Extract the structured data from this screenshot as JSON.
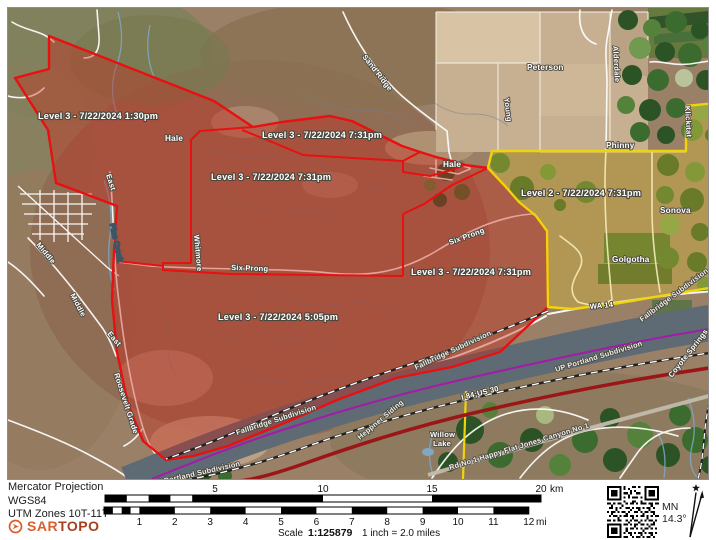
{
  "colors": {
    "level3": "#e81010",
    "level2": "#f0d40a",
    "state_line": "#a818a8",
    "interstate": "#9b1616",
    "river": "#5e6a74",
    "sartopo_orange": "#dd5f2d"
  },
  "map": {
    "zone_labels": {
      "nw": "Level 3 - 7/22/2024 1:30pm",
      "north": "Level 3 - 7/22/2024 7:31pm",
      "central": "Level 3 - 7/22/2024 7:31pm",
      "east": "Level 3 - 7/22/2024 7:31pm",
      "south": "Level 3 - 7/22/2024 5:05pm",
      "level2": "Level 2 - 7/22/2024 7:31pm"
    },
    "places": {
      "peterson": "Peterson",
      "hale_w": "Hale",
      "hale_e": "Hale",
      "phinny": "Phinny",
      "sonova": "Sonova",
      "golgotha": "Golgotha",
      "willow_line1": "Willow",
      "willow_line2": "Lake"
    },
    "roads": {
      "sand_ridge": "Sand Ridge",
      "alderdale": "Alderdale",
      "klickitat": "Klickitat",
      "young": "Young",
      "whitmore": "Whitmore",
      "east_n": "East",
      "east_s": "East",
      "middle_n": "Middle",
      "middle_s": "Middle",
      "roosevelt_grade": "Roosevelt Grade",
      "six_prong_w": "Six Prong",
      "six_prong_e": "Six Prong",
      "wa14": "WA 14",
      "i84": "I 84;US 30",
      "canyon_rd": "Rd No 1   Happy Flat Jones Canyon No 1",
      "coyote": "Coyote Springs"
    },
    "railroads": {
      "fallbridge_w": "Fallbridge Subdivision",
      "fallbridge_mid": "Fallbridge Subdivision",
      "fallbridge_e": "Fallbridge Subdivision",
      "up_portland": "UP Portland Subdivision",
      "up_portland_sw": "UP Portland Subdivision",
      "heppner_siding": "Heppner Siding"
    },
    "water": {
      "pine_creek": "Pine Creek"
    }
  },
  "footer": {
    "projection": "Mercator Projection",
    "datum": "WGS84",
    "utm_zones": "UTM Zones 10T-11T",
    "logo": {
      "sar": "SAR",
      "topo": "TOPO"
    },
    "scale_bar_km": {
      "ticks": [
        "5",
        "10",
        "15",
        "20"
      ],
      "unit": "km"
    },
    "scale_bar_mi": {
      "ticks": [
        "1",
        "2",
        "3",
        "4",
        "5",
        "6",
        "7",
        "8",
        "9",
        "10",
        "11",
        "12"
      ],
      "unit": "mi"
    },
    "scale_label": "Scale",
    "scale_value": "1:125879",
    "inch_equivalence": "1 inch = 2.0 miles",
    "declination": {
      "abbr": "MN",
      "degrees": "14.3°"
    }
  }
}
